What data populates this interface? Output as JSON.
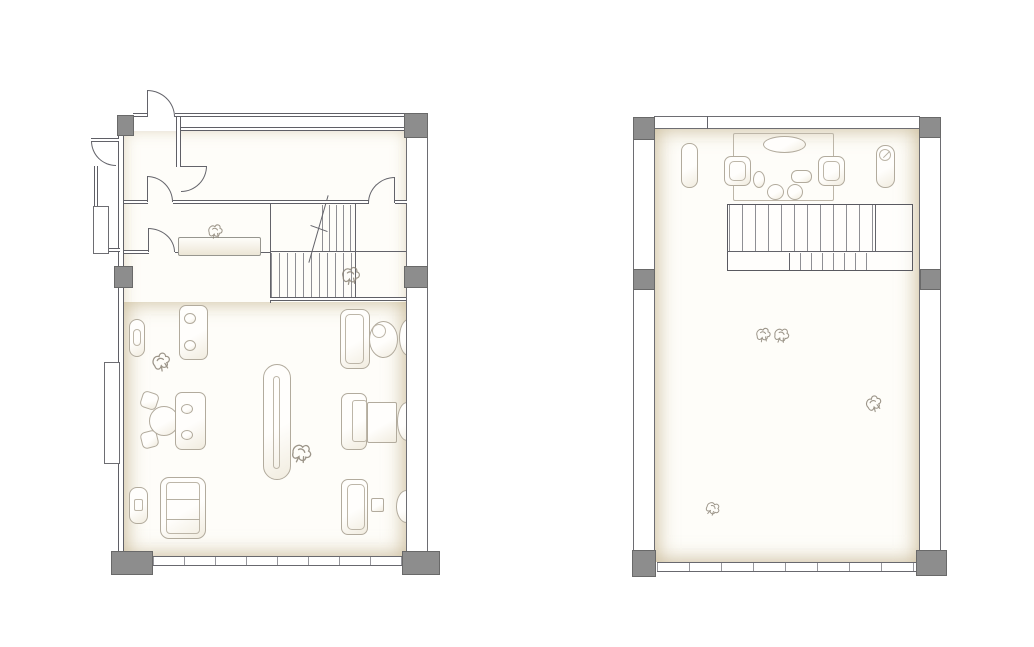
{
  "canvas": {
    "width": 1034,
    "height": 647,
    "background": "#ffffff"
  },
  "colors": {
    "wall_line": "#5f5f66",
    "column_fill": "#8d8d8d",
    "column_border": "#696969",
    "furniture_line": "#b2ab9d",
    "floor_tint": "#c8b793",
    "stair_tread": "#8f8f94",
    "sketch_line": "#8b8376"
  },
  "plans": [
    {
      "name": "lower-floor-plan",
      "elements": [
        {
          "t": "floor",
          "n": "interior-floor",
          "x": 124,
          "y": 131,
          "w": 282,
          "h": 425,
          "tint": "soft"
        },
        {
          "t": "floor",
          "n": "showroom-floor",
          "x": 124,
          "y": 302,
          "w": 282,
          "h": 254,
          "tint": "strong"
        },
        {
          "t": "treads",
          "n": "stair-upper-run-treads",
          "x": 322,
          "y": 205,
          "w": 34,
          "h": 46,
          "g": 7
        },
        {
          "t": "treads",
          "n": "stair-lower-run-treads",
          "x": 271,
          "y": 253,
          "w": 85,
          "h": 45,
          "g": 8
        },
        {
          "t": "lv",
          "n": "stair-left-edge",
          "x": 270,
          "y": 204,
          "h": 99
        },
        {
          "t": "lv",
          "n": "stair-landing-edge",
          "x": 355,
          "y": 204,
          "h": 94
        },
        {
          "t": "lh",
          "n": "stair-run-divider",
          "x": 270,
          "y": 251,
          "w": 136
        },
        {
          "t": "wallh",
          "n": "stair-bottom-wall",
          "x": 270,
          "y": 297,
          "w": 136,
          "h": 4
        },
        {
          "t": "lv",
          "n": "stair-break-line",
          "x": 318,
          "y": 194,
          "h": 70,
          "rot": 16
        },
        {
          "t": "lh",
          "n": "stair-break-tick",
          "x": 310,
          "y": 228,
          "w": 18,
          "rot": 20
        },
        {
          "t": "rect",
          "n": "wall-console",
          "x": 129,
          "y": 319,
          "w": 16,
          "h": 38,
          "r": 8
        },
        {
          "t": "irect",
          "n": "wall-console-inner",
          "x": 133,
          "y": 329,
          "w": 8,
          "h": 17,
          "r": 4
        },
        {
          "t": "rect",
          "n": "loveseat-sofa",
          "x": 179,
          "y": 305,
          "w": 29,
          "h": 55,
          "r": 7
        },
        {
          "t": "ell",
          "n": "sofa-cushion",
          "x": 184,
          "y": 313,
          "w": 12,
          "h": 11
        },
        {
          "t": "ell",
          "n": "sofa-cushion",
          "x": 184,
          "y": 340,
          "w": 12,
          "h": 11
        },
        {
          "t": "rect",
          "n": "dining-chair",
          "x": 141,
          "y": 392,
          "w": 17,
          "h": 17,
          "r": 5,
          "rot": 18
        },
        {
          "t": "rect",
          "n": "dining-chair",
          "x": 141,
          "y": 431,
          "w": 17,
          "h": 17,
          "r": 5,
          "rot": -14
        },
        {
          "t": "ell",
          "n": "round-table",
          "x": 149,
          "y": 406,
          "w": 30,
          "h": 30
        },
        {
          "t": "rect",
          "n": "settee",
          "x": 175,
          "y": 392,
          "w": 31,
          "h": 58,
          "r": 7
        },
        {
          "t": "ell",
          "n": "settee-cushion",
          "x": 181,
          "y": 404,
          "w": 12,
          "h": 10
        },
        {
          "t": "ell",
          "n": "settee-cushion",
          "x": 181,
          "y": 430,
          "w": 12,
          "h": 10
        },
        {
          "t": "rect",
          "n": "daybed",
          "x": 160,
          "y": 477,
          "w": 46,
          "h": 62,
          "r": 9
        },
        {
          "t": "irect",
          "n": "daybed-inner",
          "x": 166,
          "y": 482,
          "w": 34,
          "h": 52,
          "r": 4
        },
        {
          "t": "lh",
          "n": "daybed-line",
          "x": 166,
          "y": 499,
          "w": 34,
          "c": "furn"
        },
        {
          "t": "lh",
          "n": "daybed-line",
          "x": 166,
          "y": 519,
          "w": 34,
          "c": "furn"
        },
        {
          "t": "rect",
          "n": "ottoman",
          "x": 129,
          "y": 487,
          "w": 19,
          "h": 37,
          "r": 8
        },
        {
          "t": "irect",
          "n": "ottoman-inner",
          "x": 134,
          "y": 499,
          "w": 9,
          "h": 12,
          "r": 2
        },
        {
          "t": "rect",
          "n": "display-island",
          "x": 263,
          "y": 364,
          "w": 28,
          "h": 116,
          "r": 14
        },
        {
          "t": "irect",
          "n": "display-island-inner",
          "x": 273,
          "y": 376,
          "w": 7,
          "h": 93,
          "r": 4
        },
        {
          "t": "rect",
          "n": "workstation-sofa",
          "x": 340,
          "y": 309,
          "w": 30,
          "h": 60,
          "r": 8
        },
        {
          "t": "irect",
          "n": "workstation-sofa-inner",
          "x": 345,
          "y": 314,
          "w": 19,
          "h": 50,
          "r": 5
        },
        {
          "t": "ell",
          "n": "tub-chair",
          "x": 369,
          "y": 321,
          "w": 29,
          "h": 37
        },
        {
          "t": "iell",
          "n": "tub-chair-inner",
          "x": 372,
          "y": 324,
          "w": 14,
          "h": 14
        },
        {
          "t": "ell",
          "n": "side-ottoman",
          "x": 399,
          "y": 319,
          "w": 19,
          "h": 37
        },
        {
          "t": "rect",
          "n": "desk-chair",
          "x": 341,
          "y": 393,
          "w": 26,
          "h": 57,
          "r": 7
        },
        {
          "t": "irect",
          "n": "desk-chair-inner",
          "x": 352,
          "y": 400,
          "w": 15,
          "h": 42,
          "r": 3
        },
        {
          "t": "rect",
          "n": "desk-table",
          "x": 367,
          "y": 402,
          "w": 30,
          "h": 41,
          "r": 2
        },
        {
          "t": "ell",
          "n": "side-ottoman",
          "x": 397,
          "y": 402,
          "w": 20,
          "h": 39
        },
        {
          "t": "rect",
          "n": "bench-sofa",
          "x": 341,
          "y": 479,
          "w": 27,
          "h": 56,
          "r": 7
        },
        {
          "t": "irect",
          "n": "bench-sofa-inner",
          "x": 347,
          "y": 484,
          "w": 18,
          "h": 46,
          "r": 5
        },
        {
          "t": "rect",
          "n": "side-table",
          "x": 371,
          "y": 498,
          "w": 13,
          "h": 14,
          "r": 2
        },
        {
          "t": "ell",
          "n": "side-ottoman",
          "x": 396,
          "y": 490,
          "w": 21,
          "h": 33
        },
        {
          "t": "wallh",
          "n": "top-wall",
          "x": 133,
          "y": 113,
          "w": 14,
          "h": 4
        },
        {
          "t": "wallh",
          "n": "top-wall",
          "x": 175,
          "y": 113,
          "w": 253,
          "h": 4
        },
        {
          "t": "wallh",
          "n": "top-wall-inner",
          "x": 176,
          "y": 127,
          "w": 231,
          "h": 4
        },
        {
          "t": "wallv",
          "n": "left-wall",
          "x": 118,
          "y": 135,
          "w": 6,
          "h": 417
        },
        {
          "t": "wallh",
          "n": "entry-stub-wall",
          "x": 91,
          "y": 138,
          "w": 28,
          "h": 4
        },
        {
          "t": "wallv",
          "n": "entry-side-wall",
          "x": 94,
          "y": 166,
          "w": 4,
          "h": 85
        },
        {
          "t": "wallh",
          "n": "entry-stub-wall",
          "x": 94,
          "y": 248,
          "w": 26,
          "h": 4
        },
        {
          "t": "band",
          "n": "wall-pilaster",
          "x": 93,
          "y": 206,
          "w": 16,
          "h": 48
        },
        {
          "t": "band",
          "n": "wall-pilaster",
          "x": 104,
          "y": 362,
          "w": 16,
          "h": 102
        },
        {
          "t": "band",
          "n": "right-wall",
          "x": 406,
          "y": 135,
          "w": 22,
          "h": 417
        },
        {
          "t": "wallv",
          "n": "vestibule-partition",
          "x": 176,
          "y": 117,
          "w": 5,
          "h": 50
        },
        {
          "t": "wallh",
          "n": "corridor-wall",
          "x": 124,
          "y": 200,
          "w": 24,
          "h": 4
        },
        {
          "t": "wallh",
          "n": "corridor-wall",
          "x": 173,
          "y": 200,
          "w": 196,
          "h": 4
        },
        {
          "t": "wallh",
          "n": "corridor-wall",
          "x": 395,
          "y": 200,
          "w": 12,
          "h": 4
        },
        {
          "t": "wallh",
          "n": "corridor-wall",
          "x": 124,
          "y": 250,
          "w": 25,
          "h": 4
        },
        {
          "t": "lh",
          "n": "corridor-line",
          "x": 175,
          "y": 252,
          "w": 96
        },
        {
          "t": "win",
          "n": "window-band",
          "x": 153,
          "y": 556,
          "w": 249,
          "h": 10,
          "g": 31
        },
        {
          "t": "col",
          "n": "column",
          "x": 117,
          "y": 115,
          "w": 17,
          "h": 21
        },
        {
          "t": "col",
          "n": "column",
          "x": 404,
          "y": 113,
          "w": 24,
          "h": 25
        },
        {
          "t": "col",
          "n": "column",
          "x": 114,
          "y": 266,
          "w": 19,
          "h": 22
        },
        {
          "t": "col",
          "n": "column",
          "x": 404,
          "y": 266,
          "w": 24,
          "h": 22
        },
        {
          "t": "col",
          "n": "column",
          "x": 111,
          "y": 551,
          "w": 42,
          "h": 24
        },
        {
          "t": "col",
          "n": "column",
          "x": 402,
          "y": 551,
          "w": 38,
          "h": 24
        },
        {
          "t": "door",
          "n": "entry-door",
          "x": 147,
          "y": 90,
          "w": 28,
          "h": 27,
          "c": "tr",
          "l": "w"
        },
        {
          "t": "door",
          "n": "side-entry-door",
          "x": 91,
          "y": 141,
          "w": 25,
          "h": 25,
          "c": "bl",
          "l": "n"
        },
        {
          "t": "door",
          "n": "vestibule-door",
          "x": 147,
          "y": 176,
          "w": 26,
          "h": 26,
          "c": "tr",
          "l": "w"
        },
        {
          "t": "door",
          "n": "room-door",
          "x": 181,
          "y": 166,
          "w": 26,
          "h": 26,
          "c": "br",
          "l": "n"
        },
        {
          "t": "door",
          "n": "corridor-door",
          "x": 148,
          "y": 228,
          "w": 27,
          "h": 24,
          "c": "tr",
          "l": "w"
        },
        {
          "t": "door",
          "n": "upper-room-door",
          "x": 368,
          "y": 177,
          "w": 27,
          "h": 26,
          "c": "tl",
          "l": "e"
        },
        {
          "t": "counter",
          "n": "reception-counter",
          "x": 178,
          "y": 237,
          "w": 83,
          "h": 19
        },
        {
          "t": "sketch",
          "n": "decor-sketch",
          "x": 203,
          "y": 220,
          "w": 24,
          "h": 20
        },
        {
          "t": "sketch",
          "n": "plant-sketch",
          "x": 338,
          "y": 260,
          "w": 25,
          "h": 28
        },
        {
          "t": "sketch",
          "n": "plant-sketch",
          "x": 148,
          "y": 348,
          "w": 25,
          "h": 25,
          "rot": -20
        },
        {
          "t": "sketch",
          "n": "plant-sketch",
          "x": 288,
          "y": 438,
          "w": 27,
          "h": 27,
          "rot": 15
        }
      ]
    },
    {
      "name": "upper-floor-plan",
      "elements": [
        {
          "t": "floor",
          "n": "loft-floor",
          "x": 655,
          "y": 129,
          "w": 264,
          "h": 433,
          "tint": "strong"
        },
        {
          "t": "box",
          "n": "stair-enclosure",
          "x": 727,
          "y": 204,
          "w": 186,
          "h": 67
        },
        {
          "t": "treads",
          "n": "stair-upper-run-treads",
          "x": 729,
          "y": 205,
          "w": 146,
          "h": 46,
          "g": 13
        },
        {
          "t": "treads",
          "n": "stair-lower-run-treads",
          "x": 789,
          "y": 253,
          "w": 88,
          "h": 17,
          "g": 11
        },
        {
          "t": "lh",
          "n": "stair-run-divider",
          "x": 727,
          "y": 251,
          "w": 186
        },
        {
          "t": "lv",
          "n": "stair-landing-edge",
          "x": 875,
          "y": 205,
          "h": 46
        },
        {
          "t": "lv",
          "n": "stair-lower-edge",
          "x": 789,
          "y": 253,
          "h": 17
        },
        {
          "t": "irect",
          "n": "rug",
          "x": 733,
          "y": 133,
          "w": 101,
          "h": 68,
          "r": 2
        },
        {
          "t": "ell",
          "n": "oval-table",
          "x": 763,
          "y": 136,
          "w": 43,
          "h": 17
        },
        {
          "t": "rect",
          "n": "armchair",
          "x": 724,
          "y": 156,
          "w": 27,
          "h": 30,
          "r": 7
        },
        {
          "t": "irect",
          "n": "armchair-inner",
          "x": 729,
          "y": 161,
          "w": 17,
          "h": 20,
          "r": 5
        },
        {
          "t": "rect",
          "n": "armchair",
          "x": 818,
          "y": 156,
          "w": 27,
          "h": 30,
          "r": 7
        },
        {
          "t": "irect",
          "n": "armchair-inner",
          "x": 823,
          "y": 161,
          "w": 17,
          "h": 20,
          "r": 5
        },
        {
          "t": "ell",
          "n": "side-table",
          "x": 753,
          "y": 171,
          "w": 12,
          "h": 17
        },
        {
          "t": "rect",
          "n": "tray-table",
          "x": 791,
          "y": 170,
          "w": 21,
          "h": 13,
          "r": 6
        },
        {
          "t": "ell",
          "n": "pouf",
          "x": 767,
          "y": 184,
          "w": 17,
          "h": 16
        },
        {
          "t": "ell",
          "n": "pouf",
          "x": 787,
          "y": 184,
          "w": 16,
          "h": 16
        },
        {
          "t": "rect",
          "n": "bench",
          "x": 681,
          "y": 143,
          "w": 17,
          "h": 45,
          "r": 8
        },
        {
          "t": "rect",
          "n": "decor-stand",
          "x": 876,
          "y": 145,
          "w": 19,
          "h": 43,
          "r": 9
        },
        {
          "t": "iell",
          "n": "decor-stand-dial",
          "x": 879,
          "y": 149,
          "w": 12,
          "h": 12
        },
        {
          "t": "lh",
          "n": "decor-stand-needle",
          "x": 882,
          "y": 154,
          "w": 9,
          "rot": -45,
          "c": "furn"
        },
        {
          "t": "band",
          "n": "top-wall",
          "x": 654,
          "y": 116,
          "w": 266,
          "h": 13
        },
        {
          "t": "lv",
          "n": "top-wall-divider",
          "x": 707,
          "y": 116,
          "h": 13
        },
        {
          "t": "band",
          "n": "left-wall",
          "x": 633,
          "y": 138,
          "w": 22,
          "h": 414
        },
        {
          "t": "band",
          "n": "right-wall",
          "x": 919,
          "y": 136,
          "w": 22,
          "h": 416
        },
        {
          "t": "win",
          "n": "window-band",
          "x": 657,
          "y": 562,
          "w": 260,
          "h": 10,
          "g": 32
        },
        {
          "t": "col",
          "n": "column",
          "x": 633,
          "y": 117,
          "w": 22,
          "h": 23
        },
        {
          "t": "col",
          "n": "column",
          "x": 919,
          "y": 117,
          "w": 22,
          "h": 21
        },
        {
          "t": "col",
          "n": "column",
          "x": 633,
          "y": 269,
          "w": 22,
          "h": 21
        },
        {
          "t": "col",
          "n": "column",
          "x": 920,
          "y": 269,
          "w": 21,
          "h": 21
        },
        {
          "t": "col",
          "n": "column",
          "x": 632,
          "y": 550,
          "w": 24,
          "h": 27
        },
        {
          "t": "col",
          "n": "column",
          "x": 916,
          "y": 550,
          "w": 31,
          "h": 26
        },
        {
          "t": "sketch",
          "n": "plant-sketch",
          "x": 753,
          "y": 322,
          "w": 20,
          "h": 23
        },
        {
          "t": "sketch",
          "n": "plant-sketch",
          "x": 771,
          "y": 321,
          "w": 21,
          "h": 26,
          "rot": 12
        },
        {
          "t": "sketch",
          "n": "plant-sketch",
          "x": 862,
          "y": 389,
          "w": 22,
          "h": 27,
          "rot": -25
        },
        {
          "t": "sketch",
          "n": "plant-sketch",
          "x": 703,
          "y": 498,
          "w": 20,
          "h": 19,
          "rot": 30
        }
      ]
    }
  ]
}
